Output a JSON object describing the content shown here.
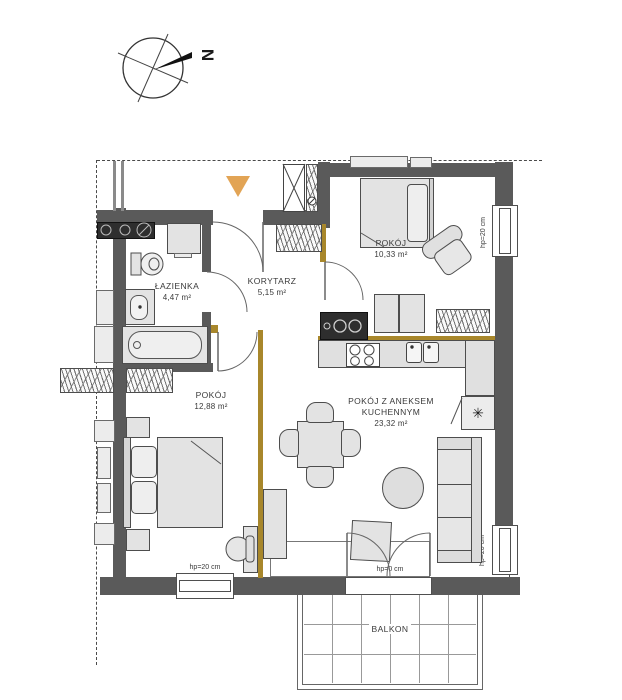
{
  "compass": {
    "north_label": "N"
  },
  "rooms": {
    "bathroom": {
      "name": "ŁAZIENKA",
      "area": "4,47 m²"
    },
    "corridor": {
      "name": "KORYTARZ",
      "area": "5,15 m²"
    },
    "bedroom_small": {
      "name": "POKÓJ",
      "area": "10,33 m²"
    },
    "bedroom_large": {
      "name": "POKÓJ",
      "area": "12,88 m²"
    },
    "living_kitchen": {
      "name_line1": "POKÓJ Z ANEKSEM",
      "name_line2": "KUCHENNYM",
      "area": "23,32 m²"
    },
    "balcony": {
      "name": "BALKON"
    }
  },
  "labels": {
    "sill_height_20": "hp=20 cm",
    "sill_height_0": "hp=0 cm",
    "fridge_symbol": "✳"
  },
  "colors": {
    "wall": "#5a5a5a",
    "gold_partition": "#a8872b",
    "entrance_marker": "#e2a455",
    "furniture_fill": "#e3e3e3"
  }
}
